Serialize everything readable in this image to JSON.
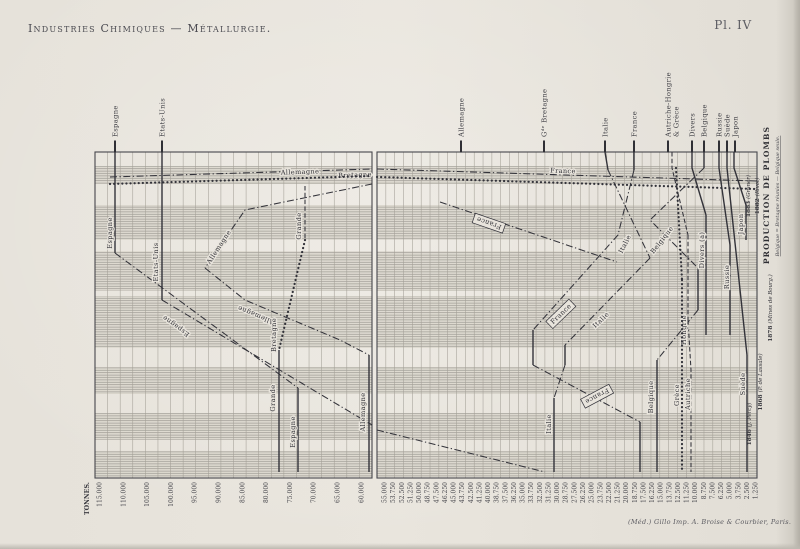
{
  "header": {
    "title": "Industries Chimiques — Métallurgie.",
    "plate": "Pl. IV"
  },
  "imprint": "(Méd.) Gillo Imp. A. Broise & Courbier, Paris.",
  "right_margin": {
    "cols": [
      {
        "year": "1883",
        "source": "(Gruner)",
        "x": 750,
        "y": 196
      },
      {
        "year": "1882",
        "source": "(Rivot)",
        "x": 759,
        "y": 196
      }
    ],
    "title": "PRODUCTION DE PLOMBS",
    "note": "Belgique = Bretagne réunies — Belgique seule.",
    "rows": [
      {
        "year": "1878",
        "source": "(Mines de Bourg.)",
        "x": 772,
        "y": 308
      },
      {
        "year": "1868",
        "source": "(P. de Lassale)",
        "x": 762,
        "y": 382
      },
      {
        "year": "1846",
        "source": "(J. Percy)",
        "x": 751,
        "y": 424
      }
    ]
  },
  "axis": {
    "unit_label": "TONNES.",
    "left_scale_labels": [
      "115.000",
      "110.000",
      "105.000",
      "100.000",
      "95.000",
      "90.000",
      "85.000",
      "80.000",
      "75.000",
      "70.000",
      "65.000",
      "60.000"
    ],
    "right_scale_labels": [
      "55.000",
      "53.750",
      "52.500",
      "51.250",
      "50.000",
      "48.750",
      "47.500",
      "46.250",
      "45.000",
      "43.750",
      "42.500",
      "41.250",
      "40.000",
      "38.750",
      "37.500",
      "36.250",
      "35.000",
      "33.750",
      "32.500",
      "31.250",
      "30.000",
      "28.750",
      "27.500",
      "26.250",
      "25.000",
      "23.750",
      "22.500",
      "21.250",
      "20.000",
      "18.750",
      "17.500",
      "16.250",
      "15.000",
      "13.750",
      "12.500",
      "11.250",
      "10.000",
      "8.750",
      "7.500",
      "6.250",
      "5.000",
      "3.750",
      "2.500",
      "1.250"
    ]
  },
  "top_labels": [
    {
      "t": "Espagne",
      "x": 115
    },
    {
      "t": "Etats-Unis",
      "x": 162
    },
    {
      "t": "Allemagne",
      "x": 461
    },
    {
      "t": "Gᵈᵉ Bretagne",
      "x": 544
    },
    {
      "t": "Italie",
      "x": 605
    },
    {
      "t": "France",
      "x": 634
    },
    {
      "t": "Autriche-Hongrie",
      "x": 668
    },
    {
      "t": "& Grèce",
      "x": 676,
      "tick": false
    },
    {
      "t": "Divers",
      "x": 692
    },
    {
      "t": "Belgique",
      "x": 704
    },
    {
      "t": "Russie",
      "x": 719
    },
    {
      "t": "Suède",
      "x": 727
    },
    {
      "t": "Japon",
      "x": 735
    }
  ],
  "chart_data": {
    "type": "line",
    "title": "Production de plombs",
    "unit": "tonnes",
    "orientation": "value on horizontal axis, time descending vertically (1883 top → 1846 bottom)",
    "values_approximate": true,
    "years": [
      "1883",
      "1882",
      "1878",
      "1868",
      "1846"
    ],
    "sources_by_year": [
      "(Gruner)",
      "(Rivot)",
      "(Mines de Bourg.)",
      "(P. de Lassale)",
      "(J. Percy)"
    ],
    "x_axis": {
      "left_panel": {
        "max": 115000,
        "min": 60000,
        "label_step": 5000
      },
      "right_panel": {
        "max": 55000,
        "min": 1250,
        "label_step": 1250
      }
    },
    "series": [
      {
        "name": "Espagne",
        "values": [
          112000,
          111000,
          96000,
          77000,
          73000
        ]
      },
      {
        "name": "Etats-Unis",
        "values": [
          102000,
          102000,
          88000,
          null,
          null
        ]
      },
      {
        "name": "Allemagne",
        "values": [
          43500,
          84000,
          75000,
          58000,
          58000
        ]
      },
      {
        "name": "Grande-Bretagne",
        "values": [
          31300,
          72500,
          77000,
          77500,
          77500
        ]
      },
      {
        "name": "Italie",
        "values": [
          22400,
          18500,
          24500,
          30000,
          30000
        ]
      },
      {
        "name": "France",
        "values": [
          18200,
          20000,
          32000,
          33000,
          17500
        ]
      },
      {
        "name": "Autriche-Hongrie",
        "values": [
          12700,
          11000,
          10300,
          10000,
          10000
        ]
      },
      {
        "name": "Grèce",
        "values": [
          null,
          null,
          11000,
          11200,
          11200
        ]
      },
      {
        "name": "Divers",
        "values": [
          9700,
          8500,
          8100,
          null,
          null
        ]
      },
      {
        "name": "Belgique",
        "values": [
          7900,
          14000,
          7400,
          14600,
          14600
        ]
      },
      {
        "name": "Russie",
        "values": [
          5800,
          4800,
          4200,
          null,
          null
        ]
      },
      {
        "name": "Suède",
        "values": [
          4600,
          3500,
          2500,
          1700,
          1700
        ]
      },
      {
        "name": "Japon",
        "values": [
          3600,
          2300,
          1900,
          null,
          null
        ]
      }
    ],
    "layout": {
      "frame": {
        "left_panel": [
          95,
          152,
          277,
          326
        ],
        "right_panel": [
          377,
          152,
          380,
          326
        ]
      },
      "bands_y": [
        [
          166,
          184
        ],
        [
          205,
          240
        ],
        [
          251,
          291
        ],
        [
          296,
          348
        ],
        [
          367,
          394
        ],
        [
          413,
          440
        ],
        [
          451,
          477
        ]
      ],
      "grid": {
        "left": {
          "x0": 95,
          "step": 12.5909,
          "n": 23
        },
        "right": {
          "x0": 377,
          "step": 8.8372,
          "n": 44
        }
      },
      "scale_ticks": {
        "left": {
          "x0": 99.5,
          "step": 23.8
        },
        "right": {
          "x0": 384.5,
          "step": 8.63
        }
      },
      "lines": [
        {
          "name": "espagne",
          "segs": [
            {
              "p": "115,152 115,253",
              "s": "solid"
            },
            {
              "p": "115,253 298,388",
              "s": "dashdot"
            },
            {
              "p": "298,388 298,472",
              "s": "solid"
            }
          ],
          "labels": [
            {
              "t": "Espagne",
              "x": 110,
              "y": 233,
              "r": -90
            },
            {
              "t": "Espagne",
              "x": 176,
              "y": 326,
              "r": 216
            },
            {
              "t": "Espagne",
              "x": 293,
              "y": 432,
              "r": -90
            }
          ]
        },
        {
          "name": "etats-unis",
          "segs": [
            {
              "p": "162,152 162,300",
              "s": "solid"
            },
            {
              "p": "162,300 372,425",
              "s": "dashdot"
            }
          ],
          "labels": [
            {
              "t": "Etats-Unis",
              "x": 156,
              "y": 262,
              "r": -90
            }
          ]
        },
        {
          "name": "allemagne-gauche",
          "segs": [
            {
              "p": "372,184 245,210 205,268",
              "s": "dashdot"
            },
            {
              "p": "205,268 245,300 340,340 369,355",
              "s": "dashdot"
            },
            {
              "p": "369,355 369,472",
              "s": "solid"
            }
          ],
          "labels": [
            {
              "t": "Allemagne",
              "x": 219,
              "y": 247,
              "r": -57
            },
            {
              "t": "Allemagne",
              "x": 256,
              "y": 315,
              "r": 203
            },
            {
              "t": "Allemagne",
              "x": 363,
              "y": 412,
              "r": -90
            }
          ]
        },
        {
          "name": "grande-bretagne-gauche",
          "segs": [
            {
              "p": "305,186 305,240",
              "s": "dashed"
            },
            {
              "p": "305,240 279,350",
              "s": "dotted"
            },
            {
              "p": "279,350 279,472",
              "s": "solid"
            }
          ],
          "labels": [
            {
              "t": "Grande",
              "x": 299,
              "y": 226,
              "r": -90
            },
            {
              "t": "Bretagne",
              "x": 274,
              "y": 335,
              "r": -90
            },
            {
              "t": "Grande",
              "x": 273,
              "y": 398,
              "r": -90
            }
          ]
        },
        {
          "name": "bande-haute-a",
          "segs": [
            {
              "p": "110,177 372,169",
              "s": "dashdot"
            },
            {
              "p": "377,169 757,181",
              "s": "dashdot"
            }
          ],
          "labels": [
            {
              "t": "Allemagne",
              "x": 300,
              "y": 172,
              "r": -2,
              "hz": true
            },
            {
              "t": "Bretagne",
              "x": 355,
              "y": 175,
              "r": -2,
              "hz": true
            },
            {
              "t": "France",
              "x": 563,
              "y": 171,
              "r": 2,
              "hz": true
            }
          ]
        },
        {
          "name": "bande-haute-b",
          "segs": [
            {
              "p": "110,184 372,176",
              "s": "dotted"
            },
            {
              "p": "377,177 755,189",
              "s": "dotted"
            }
          ],
          "labels": []
        },
        {
          "name": "france",
          "segs": [
            {
              "p": "634,152 634,170",
              "s": "solid"
            },
            {
              "p": "634,170 618,235 533,330",
              "s": "dashdot"
            },
            {
              "p": "533,330 533,365",
              "s": "solid"
            },
            {
              "p": "533,365 640,422",
              "s": "dashdot"
            },
            {
              "p": "640,422 640,472",
              "s": "solid"
            }
          ],
          "labels": [
            {
              "t": "France",
              "x": 561,
              "y": 314,
              "r": -44,
              "b": true
            },
            {
              "t": "France",
              "x": 597,
              "y": 396,
              "r": 152,
              "b": true
            }
          ]
        },
        {
          "name": "france-liaison",
          "segs": [
            {
              "p": "440,202 617,262",
              "s": "dashdot"
            }
          ],
          "labels": [
            {
              "t": "France",
              "x": 489,
              "y": 223,
              "r": 199,
              "b": true
            }
          ]
        },
        {
          "name": "italie",
          "segs": [
            {
              "p": "605,152 608,170",
              "s": "solid"
            },
            {
              "p": "608,170 650,258",
              "s": "dashdot"
            },
            {
              "p": "650,258 565,345",
              "s": "dashdot"
            },
            {
              "p": "565,345 565,365",
              "s": "solid"
            },
            {
              "p": "565,365 554,398",
              "s": "dashdot"
            },
            {
              "p": "554,398 554,472",
              "s": "solid"
            }
          ],
          "labels": [
            {
              "t": "Italie",
              "x": 625,
              "y": 244,
              "r": -63
            },
            {
              "t": "Italie",
              "x": 601,
              "y": 320,
              "r": -44
            },
            {
              "t": "Italie",
              "x": 549,
              "y": 424,
              "r": -90
            }
          ]
        },
        {
          "name": "belgique",
          "segs": [
            {
              "p": "704,152 704,168",
              "s": "solid"
            },
            {
              "p": "704,168 650,220 698,268",
              "s": "dashdot"
            },
            {
              "p": "698,268 698,310",
              "s": "solid"
            },
            {
              "p": "698,310 657,360",
              "s": "dashdot"
            },
            {
              "p": "657,360 657,472",
              "s": "solid"
            }
          ],
          "labels": [
            {
              "t": "Belgique",
              "x": 662,
              "y": 240,
              "r": -52
            },
            {
              "t": "Belgique",
              "x": 651,
              "y": 397,
              "r": -90
            }
          ]
        },
        {
          "name": "autriche-hongrie",
          "segs": [
            {
              "p": "672,152 672,168 688,235",
              "s": "dashed"
            },
            {
              "p": "688,235 688,320",
              "s": "dashed"
            },
            {
              "p": "688,320 691,370 691,472",
              "s": "dashed"
            }
          ],
          "labels": [
            {
              "t": "Hongrie",
              "x": 684,
              "y": 330,
              "r": -90
            },
            {
              "t": "Autriche",
              "x": 688,
              "y": 394,
              "r": -90
            }
          ]
        },
        {
          "name": "grece",
          "segs": [
            {
              "p": "676,168 682,280",
              "s": "dotted"
            },
            {
              "p": "682,280 682,472",
              "s": "dotted"
            }
          ],
          "labels": [
            {
              "t": "Grèce",
              "x": 677,
              "y": 395,
              "r": -90
            }
          ]
        },
        {
          "name": "divers",
          "segs": [
            {
              "p": "692,152 692,168 706,215",
              "s": "solid"
            },
            {
              "p": "706,215 706,335",
              "s": "solid"
            }
          ],
          "labels": [
            {
              "t": "Divers (a)",
              "x": 702,
              "y": 250,
              "r": -90
            }
          ]
        },
        {
          "name": "russie",
          "segs": [
            {
              "p": "719,152 719,168 730,245",
              "s": "solid"
            },
            {
              "p": "730,245 730,335",
              "s": "solid"
            }
          ],
          "labels": [
            {
              "t": "Russie",
              "x": 727,
              "y": 277,
              "r": -90
            }
          ]
        },
        {
          "name": "suede",
          "segs": [
            {
              "p": "727,152 727,168",
              "s": "solid"
            },
            {
              "p": "727,168 747,355",
              "s": "solid"
            },
            {
              "p": "747,355 747,472",
              "s": "solid"
            }
          ],
          "labels": [
            {
              "t": "Suède",
              "x": 743,
              "y": 384,
              "r": -90
            }
          ]
        },
        {
          "name": "japon",
          "segs": [
            {
              "p": "734,152 734,168 746,205",
              "s": "solid"
            },
            {
              "p": "746,205 746,240",
              "s": "solid"
            }
          ],
          "labels": [
            {
              "t": "Japon",
              "x": 741,
              "y": 224,
              "r": -90
            }
          ]
        },
        {
          "name": "etats-unis-suite",
          "segs": [
            {
              "p": "377,430 545,472",
              "s": "dashdot"
            }
          ],
          "labels": []
        }
      ]
    }
  }
}
